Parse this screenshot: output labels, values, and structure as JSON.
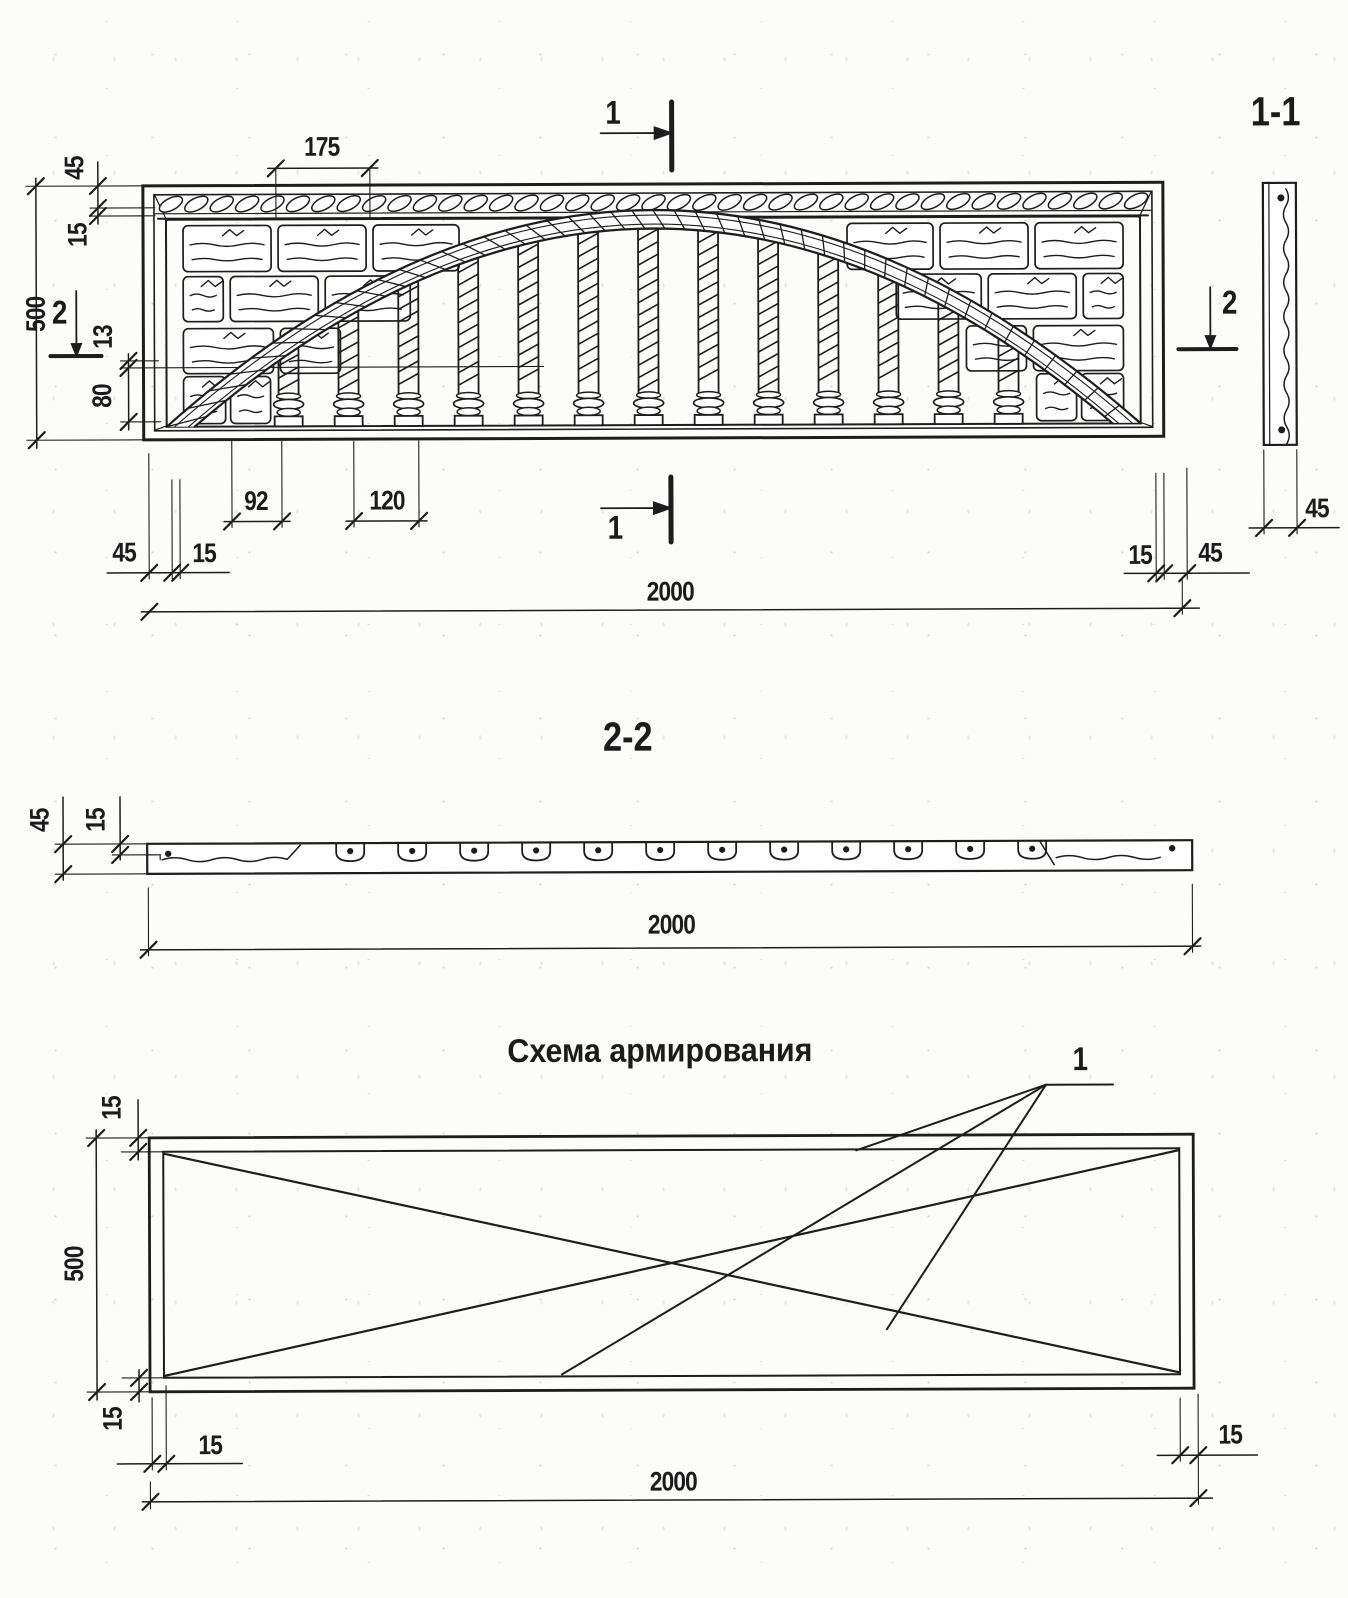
{
  "page": {
    "ink": "#1d1d1d",
    "paper": "#fcfcfb"
  },
  "elevation": {
    "marks": {
      "top": "1",
      "bottom": "1",
      "left": "2",
      "right": "2"
    },
    "dims": {
      "w175": "175",
      "h45": "45",
      "h15": "15",
      "h500": "500",
      "h13": "13",
      "h80": "80",
      "s92": "92",
      "s120": "120",
      "bl45": "45",
      "bl15": "15",
      "len2000": "2000",
      "br15": "15",
      "br45": "45"
    }
  },
  "section11": {
    "title": "1-1",
    "w45": "45"
  },
  "section22": {
    "title": "2-2",
    "dims": {
      "t45": "45",
      "t15": "15",
      "len2000": "2000"
    }
  },
  "scheme": {
    "title": "Схема армирования",
    "rebar_pos": "1",
    "dims": {
      "t15": "15",
      "h500": "500",
      "b15": "15",
      "l15": "15",
      "len2000": "2000",
      "r15": "15"
    }
  }
}
